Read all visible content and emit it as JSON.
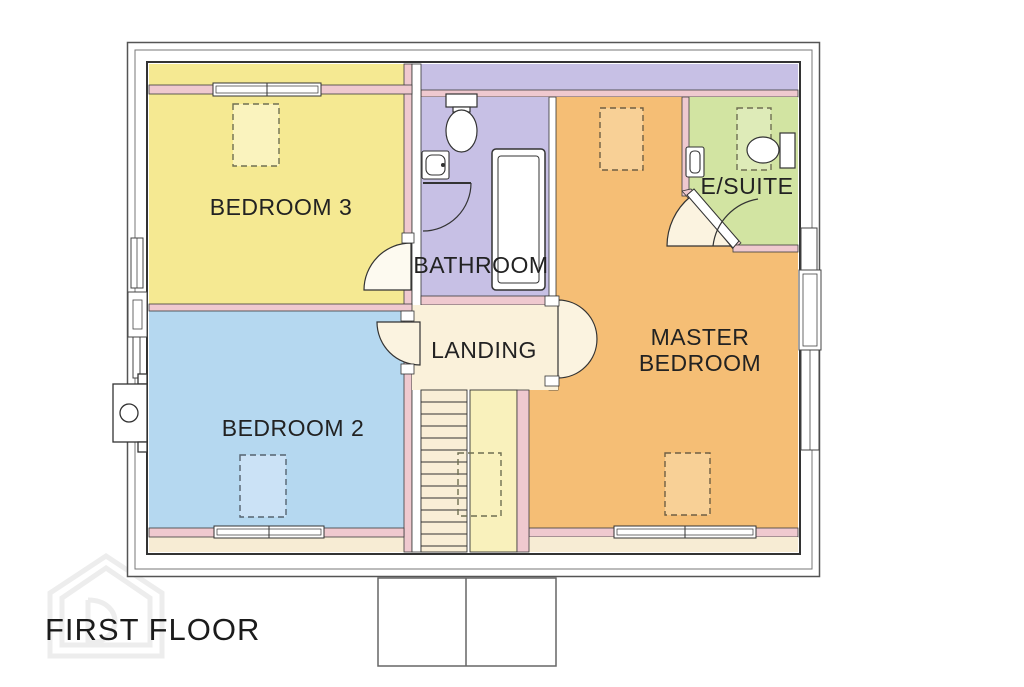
{
  "title": "FIRST FLOOR",
  "plan": {
    "rooms": {
      "bedroom3": {
        "label": "BEDROOM 3",
        "color": "#F5E992"
      },
      "bedroom2": {
        "label": "BEDROOM 2",
        "color": "#B5D8F0"
      },
      "bathroom": {
        "label": "BATHROOM",
        "color": "#C7C0E5"
      },
      "landing": {
        "label": "LANDING",
        "color": "#FAF1DA"
      },
      "master": {
        "label_line1": "MASTER",
        "label_line2": "BEDROOM",
        "color": "#F5BE75"
      },
      "esuite": {
        "label": "E/SUITE",
        "color": "#D2E4A2"
      }
    },
    "walls": {
      "color": "#EFC9CF",
      "line_color": "#3b3b3b",
      "frame_color": "#6e6e6e"
    },
    "features": {
      "top_strip_color": "#C7C0E5",
      "eaves_strip_color": "#F7ECD4",
      "stairs_color": "#F9EED6",
      "stairs_strip_color": "#F9F1BC",
      "door_fan_color": "#FBF3E0",
      "fixture_fill": "#FFFFFF",
      "skylight_dash_color": "#6f6f52",
      "skylight_fills": {
        "bedroom3": "#FAF3BE",
        "bedroom2": "#CBE2F6",
        "master": "#F8D096",
        "esuite": "#DEEBB8"
      }
    },
    "fixtures": [
      "toilet",
      "sink",
      "bathtub",
      "stairs",
      "skylight",
      "door-swing",
      "window",
      "chimney"
    ]
  },
  "watermark": {
    "present": true,
    "color": "#EDEDED"
  }
}
